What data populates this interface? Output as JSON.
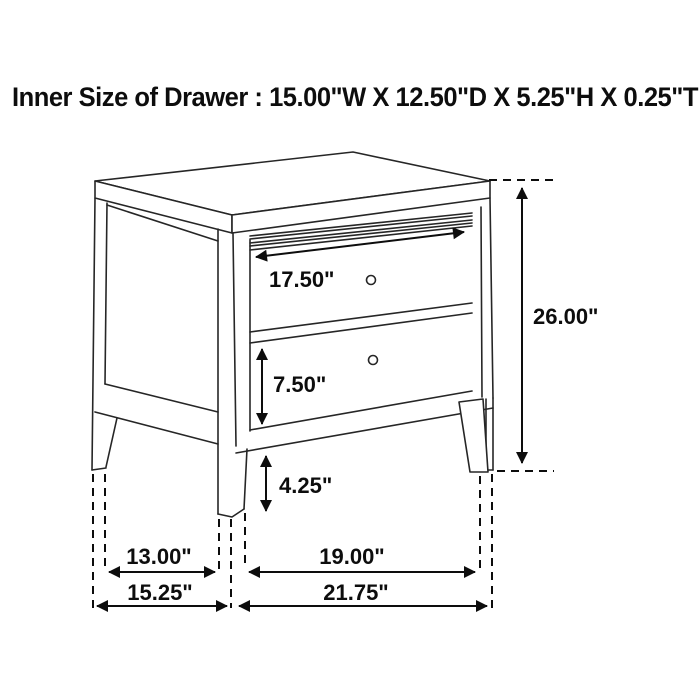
{
  "title": "Inner Size of Drawer : 15.00\"W X 12.50\"D X 5.25\"H X 0.25\"T",
  "dimensions": {
    "top_drawer_width": "17.50\"",
    "bottom_drawer_height": "7.50\"",
    "leg_clearance_height": "4.25\"",
    "overall_height": "26.00\"",
    "side_leg_span_inner": "13.00\"",
    "front_leg_span_inner": "19.00\"",
    "side_depth_overall": "15.25\"",
    "front_width_overall": "21.75\""
  },
  "colors": {
    "background": "#ffffff",
    "drawing_line": "#262626",
    "dimension_line": "#0d0d0d"
  }
}
